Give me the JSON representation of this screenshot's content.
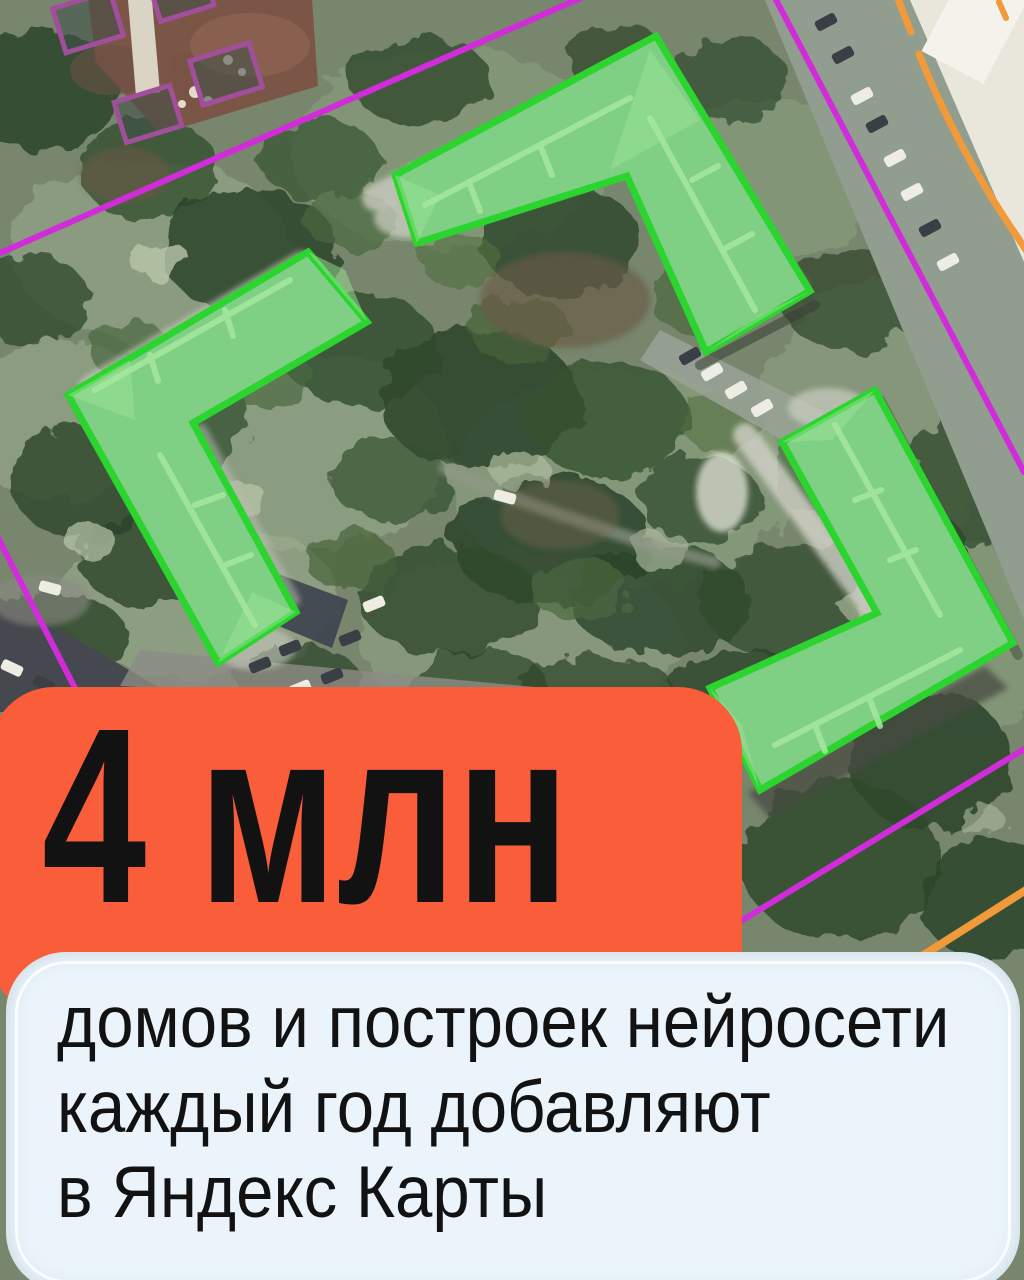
{
  "poster": {
    "headline": "4 млн",
    "subtitle_lines": [
      "домов и построек нейросети",
      "каждый год добавляют",
      "в Яндекс Карты"
    ]
  },
  "map": {
    "imagery": "satellite",
    "highlighted_building_polygons": 3,
    "court_outline_rectangles": 4,
    "colors": {
      "building_fill": "#7FD084",
      "building_outline": "#2BD42E",
      "boundary_line": "#D12CD9",
      "court_outline": "#A14E9B",
      "road_edge_line": "#F09A3A"
    }
  },
  "cards": {
    "headline_card_color": "#F95D39",
    "subtitle_card_color": "#EAF4FA",
    "text_color": "#121212"
  }
}
